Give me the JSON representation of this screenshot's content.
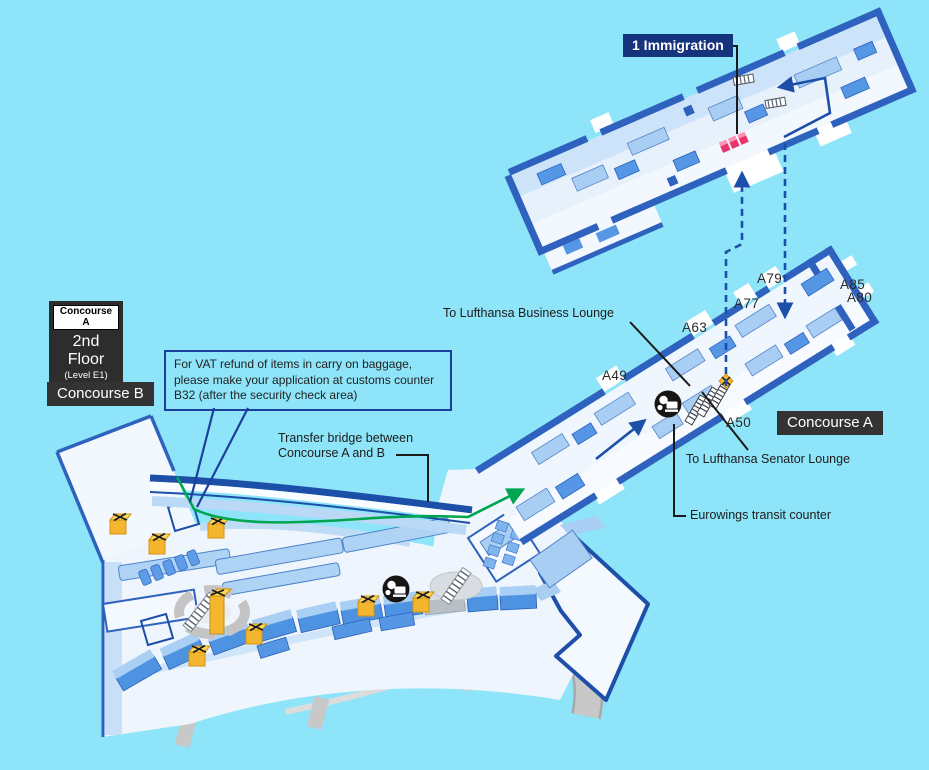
{
  "title": "Airport terminal map — Concourse A, 2nd Floor (Level E1)",
  "colors": {
    "background": "#8EE4F8",
    "wall_navy": "#2E62BE",
    "route_navy": "#1C4FA8",
    "route_green": "#00A551",
    "floor": "#EFF6FE",
    "block_light": "#A9CEF3",
    "block_medium": "#5597E5",
    "badge_bg": "#333333",
    "immigration_label_bg": "#16337E",
    "immigration_counter_pink": "#F4547F",
    "marker_yellow": "#F5B62F",
    "road_gray": "#C8C8C8"
  },
  "floor_box": {
    "concourse": "Concourse A",
    "floor": "2nd Floor",
    "level": "(Level E1)"
  },
  "badges": {
    "concourse_a": "Concourse A",
    "concourse_b": "Concourse B"
  },
  "annotations": {
    "immigration": "1 Immigration",
    "vat_note": "For VAT refund of items in carry on baggage, please make your application at customs counter B32 (after the security check area)",
    "transfer_bridge_line1": "Transfer bridge between",
    "transfer_bridge_line2": "Concourse A and B",
    "business_lounge": "To Lufthansa Business Lounge",
    "senator_lounge": "To Lufthansa Senator Lounge",
    "eurowings": "Eurowings transit counter"
  },
  "gates": [
    {
      "label": "A49"
    },
    {
      "label": "A63"
    },
    {
      "label": "A77"
    },
    {
      "label": "A79"
    },
    {
      "label": "A85"
    },
    {
      "label": "A80"
    },
    {
      "label": "A50"
    }
  ],
  "icon_names": [
    "escalator-icon",
    "elevator-icon",
    "rest-area-icon",
    "immigration-counter-icon",
    "closed-x-marker",
    "route-arrow-up",
    "route-arrow-down",
    "green-route-arrow"
  ]
}
